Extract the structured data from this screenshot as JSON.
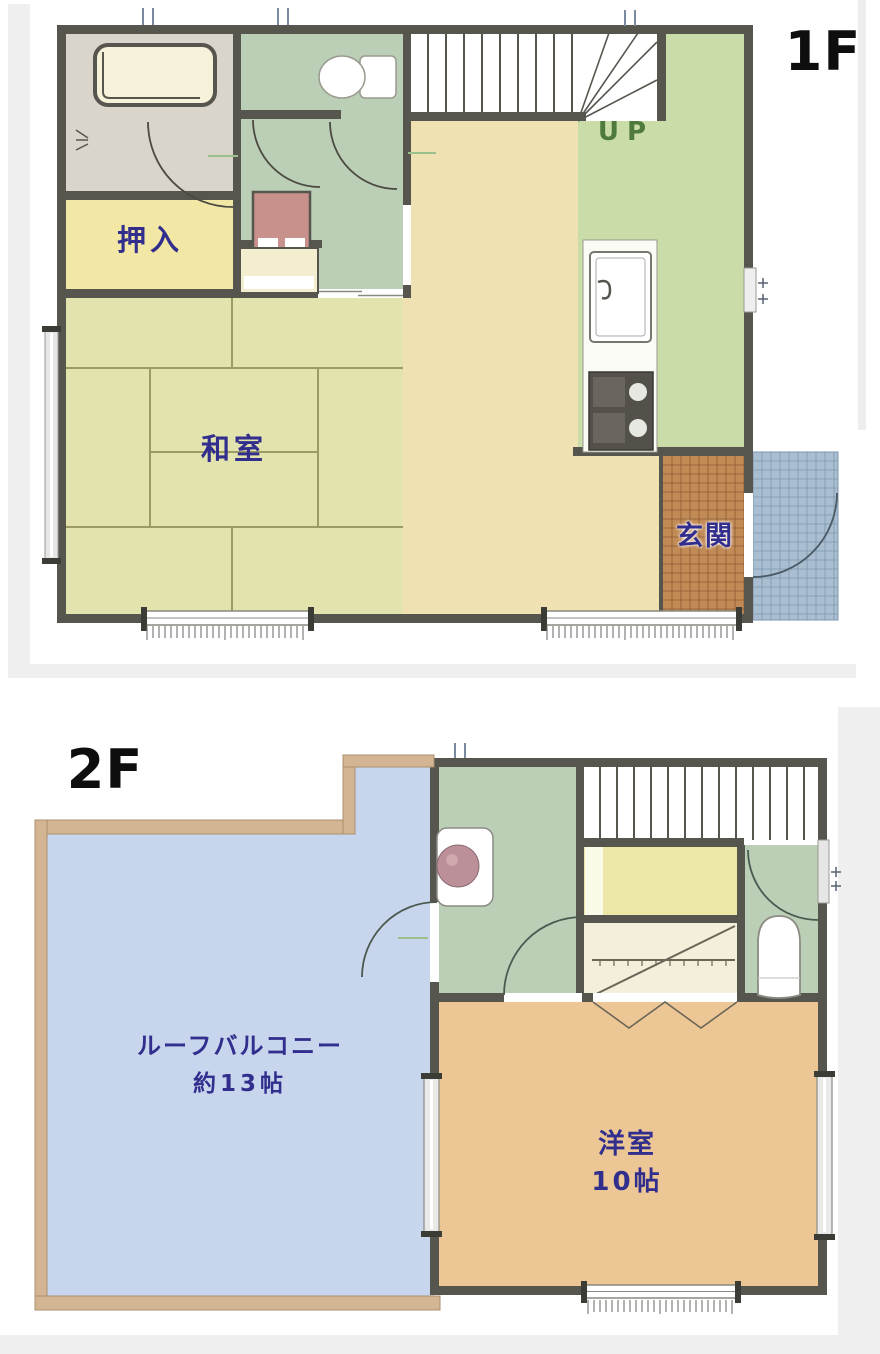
{
  "floor1": {
    "label": "1F",
    "stairs_label": "UP",
    "rooms": {
      "closet": "押入",
      "tatami_room": "和室",
      "entrance": "玄関"
    }
  },
  "floor2": {
    "label": "2F",
    "balcony_name": "ルーフバルコニー",
    "balcony_size": "約13帖",
    "western_room_name": "洋室",
    "western_room_size": "10帖"
  },
  "colors": {
    "wall_dark": "#57564e",
    "balcony_wall_tan": "#d3b493",
    "balcony_floor_blue": "#c7d6ec",
    "green_room": "#bacfb6",
    "kitchen_green": "#cadda9",
    "dk_beige": "#efe1b1",
    "tatami_green": "#e2e3ad",
    "tatami_line": "#9b9b63",
    "closet_yellow": "#f2e7a4",
    "western_room_orange": "#ecc795",
    "entrance_tile": "#c28a55",
    "porch_tile": "#aabed1",
    "bath_floor": "#d9d5cb",
    "bathtub_cream": "#f6f1d9",
    "label_navy": "#312e8d",
    "up_green": "#4e7a3d",
    "floor_label_black": "#0e0e0e",
    "panel_gray": "#efefef"
  }
}
